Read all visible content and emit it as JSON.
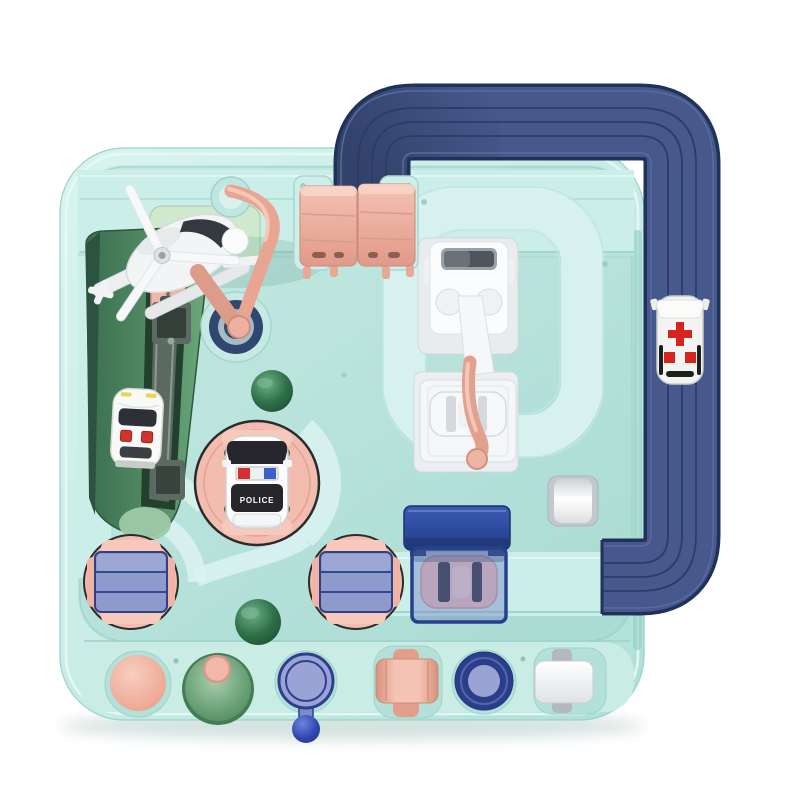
{
  "scene": {
    "domain": "natural-image",
    "subject": "Top-down product photo of a children's car adventure race-track toy playset on a white background"
  },
  "labels": {
    "police_car": "POLICE"
  },
  "colors": {
    "background": "#ffffff",
    "board_mint": "#c9ece5",
    "board_panel": "#b9e5dd",
    "track_navy": "#46588c",
    "track_outline": "#1f3259",
    "accent_pink": "#efb3a3",
    "ramp_green": "#4d8a64",
    "dome_green": "#2a6a45",
    "button_purple": "#99a3d6",
    "button_navy": "#2b3e8b",
    "slide_navy": "#2c4a9e",
    "car_white": "#f4f5f7",
    "ambulance_cross_red": "#d8241f"
  },
  "parts": [
    {
      "name": "elevated-track-loop",
      "color": "navy"
    },
    {
      "name": "ambulance",
      "color": "white with red cross"
    },
    {
      "name": "flip-bridge",
      "color": "pink"
    },
    {
      "name": "crane-arm-with-helicopter",
      "color": "pink / white"
    },
    {
      "name": "green-ramp-with-white-car",
      "color": "green / white"
    },
    {
      "name": "police-car-turntable",
      "color": "pink / black-white car"
    },
    {
      "name": "striped-turntable-left",
      "color": "pink / blue"
    },
    {
      "name": "striped-turntable-center",
      "color": "pink / blue"
    },
    {
      "name": "lift-crane-with-white-car",
      "color": "white / pink"
    },
    {
      "name": "blue-slide-canopy-with-pink-car",
      "color": "navy / pink"
    },
    {
      "name": "green-dome-upper",
      "color": "green"
    },
    {
      "name": "green-dome-lower",
      "color": "green"
    },
    {
      "name": "white-roller-button-upper",
      "color": "white / gray"
    },
    {
      "name": "pink-dome-button",
      "color": "pink"
    },
    {
      "name": "green-cone-button",
      "color": "green / pink"
    },
    {
      "name": "purple-lever-button",
      "color": "purple / blue"
    },
    {
      "name": "pink-cross-roller-button",
      "color": "pink"
    },
    {
      "name": "navy-ring-button",
      "color": "navy / purple"
    },
    {
      "name": "white-square-button",
      "color": "white / gray"
    }
  ]
}
